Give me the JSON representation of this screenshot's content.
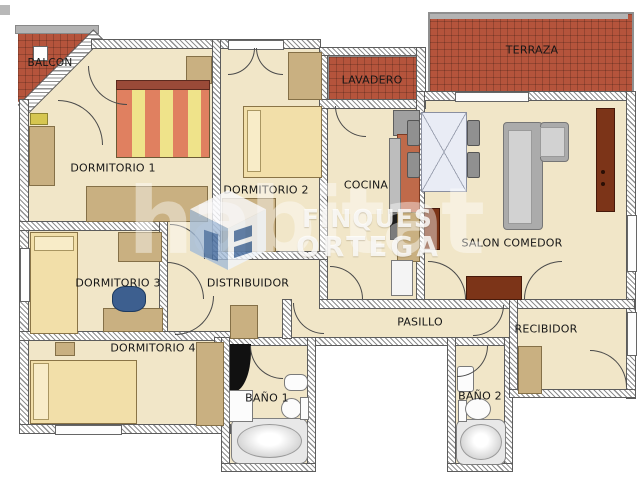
{
  "rooms": {
    "balcon": {
      "label": "BALCON"
    },
    "dormitorio1": {
      "label": "DORMITORIO 1"
    },
    "dormitorio2": {
      "label": "DORMITORIO 2"
    },
    "dormitorio3": {
      "label": "DORMITORIO 3"
    },
    "dormitorio4": {
      "label": "DORMITORIO 4"
    },
    "lavadero": {
      "label": "LAVADERO"
    },
    "terraza": {
      "label": "TERRAZA"
    },
    "cocina": {
      "label": "COCINA"
    },
    "salon": {
      "label": "SALON COMEDOR"
    },
    "distribuidor": {
      "label": "DISTRIBUIDOR"
    },
    "pasillo": {
      "label": "PASILLO"
    },
    "recibidor": {
      "label": "RECIBIDOR"
    },
    "bano1": {
      "label": "BAÑO 1"
    },
    "bano2": {
      "label": "BAÑO 2"
    }
  },
  "watermark": {
    "brand": "habitat",
    "agency_line1": "FINQUES",
    "agency_line2": "ORTEGA"
  },
  "colors": {
    "floor": "#f1e6c8",
    "tile_red": "#b5543c",
    "wood": "#c9b081",
    "dark_wood": "#7c3418",
    "sofa_gray": "#ababab",
    "bed_cream": "#f2dfa9",
    "stripe_orange": "#e08060",
    "stripe_yellow": "#efe38a"
  }
}
